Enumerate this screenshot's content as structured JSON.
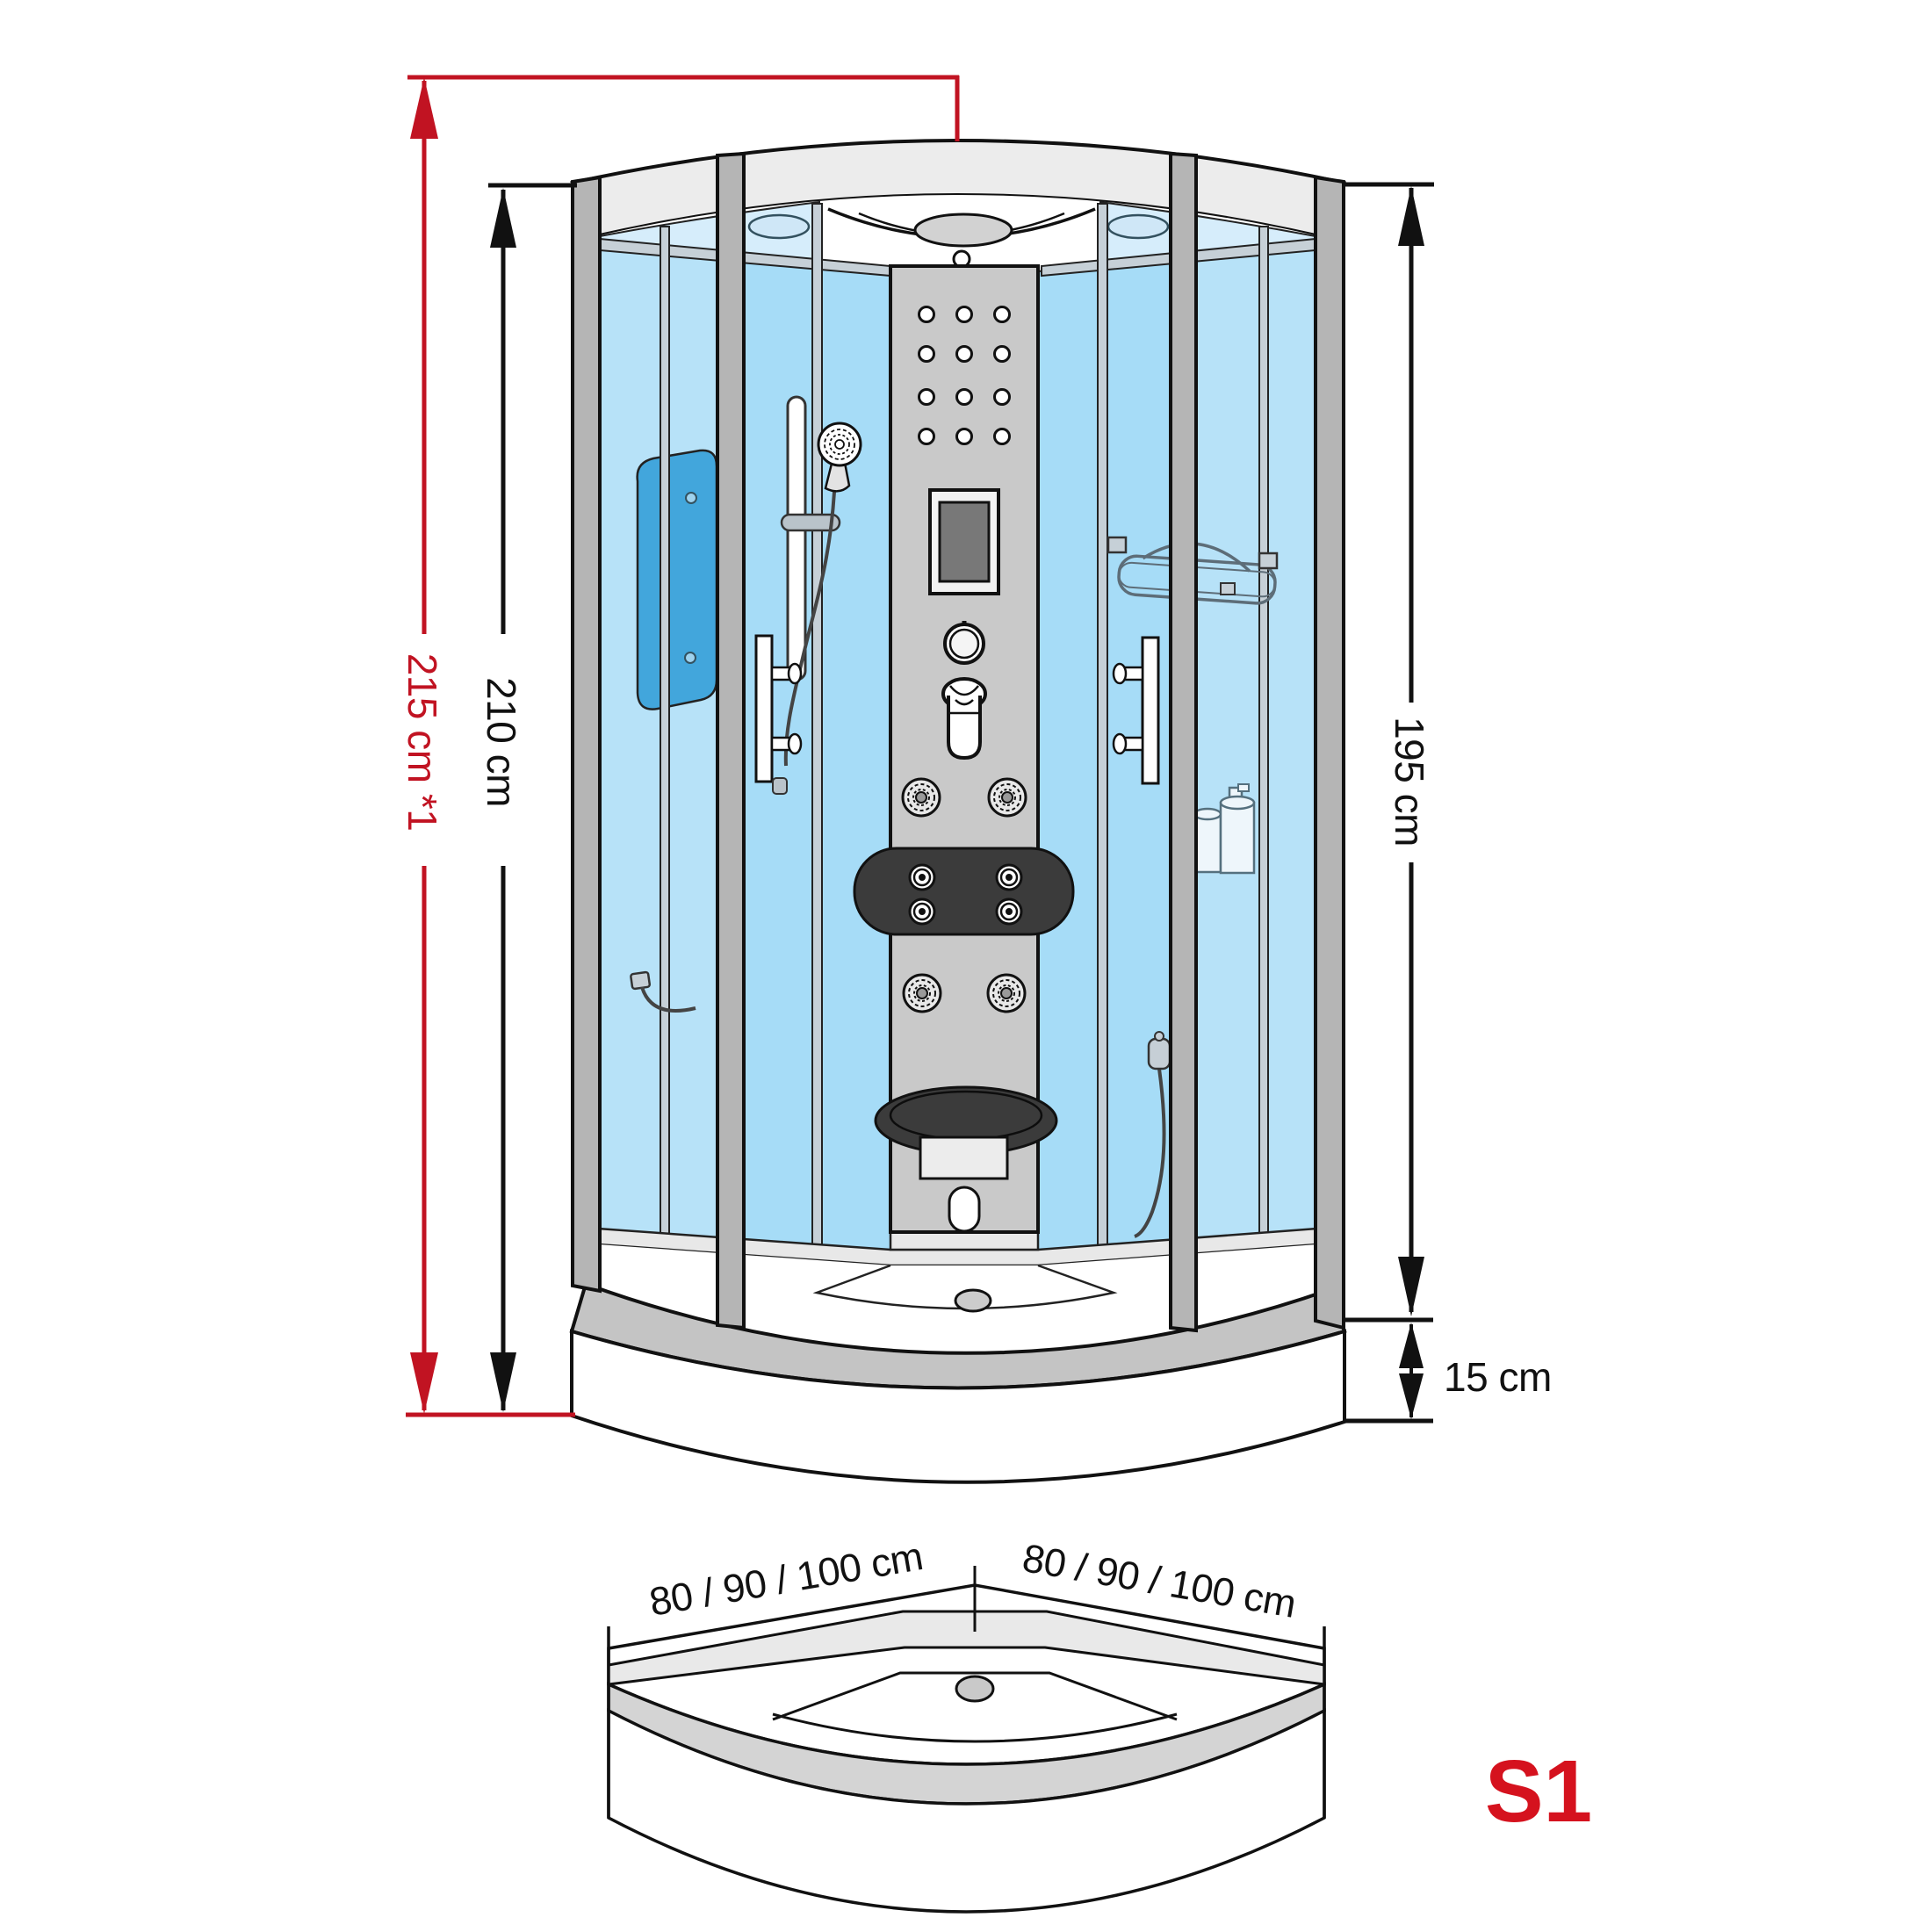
{
  "labels": {
    "total_height": "215 cm *1",
    "cabin_height": "210 cm",
    "inner_height": "195 cm",
    "tray_height": "15 cm",
    "tray_width_left": "80 / 90 / 100 cm",
    "tray_width_right": "80 / 90 / 100 cm",
    "model": "S1"
  },
  "colors": {
    "dimension-red": "#c11322",
    "model-red": "#d5121e",
    "line-black": "#111111",
    "glass-blue": "#a6dcf7",
    "glass-blue-light": "#b7e2f8",
    "glass-blue-pale": "#d6edfb",
    "mirror-blue": "#42a6dc",
    "frame-gray": "#b5b5b5",
    "panel-gray": "#c9c9c9",
    "roof-gray": "#ececec",
    "dark-accent": "#3b3b3b"
  }
}
